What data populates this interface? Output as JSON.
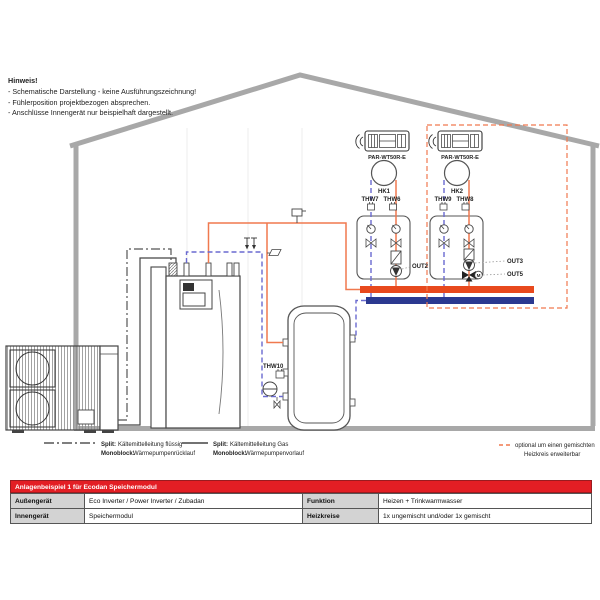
{
  "hinweis": {
    "title": "Hinweis!",
    "line1": "- Schematische Darstellung - keine Ausführungszeichnung!",
    "line2": "- Fühlerposition projektbezogen absprechen.",
    "line3": "- Anschlüsse Innengerät nur beispielhaft dargestellt."
  },
  "hk1": {
    "controller": "PAR-WT50R-E",
    "zone": "HK1",
    "sensor_return": "THW7",
    "sensor_flow": "THW6",
    "out_pump": "OUT2"
  },
  "hk2": {
    "controller": "PAR-WT50R-E",
    "zone": "HK2",
    "sensor_return": "THW9",
    "sensor_flow": "THW8",
    "out_pump": "OUT3",
    "out_mixer": "OUT5",
    "mixer_motor": "M"
  },
  "tank": {
    "sensor": "THW10"
  },
  "legend": {
    "item1": {
      "label1": "Split:",
      "text1": "Kältemittelleitung flüssig",
      "label2": "Monoblock:",
      "text2": "Wärmepumpenrücklauf"
    },
    "item2": {
      "label1": "Split:",
      "text1": "Kältemittelleitung Gas",
      "label2": "Monoblock:",
      "text2": "Wärmepumpenvorlauf"
    },
    "item3": {
      "line1": "optional um einen gemischten",
      "line2": "Heizkreis erweiterbar"
    }
  },
  "table": {
    "header": "Anlagenbeispiel 1 für Ecodan Speichermodul",
    "rows": [
      {
        "label1": "Außengerät",
        "value1": "Eco Inverter / Power Inverter / Zubadan",
        "label2": "Funktion",
        "value2": "Heizen + Trinkwarmwasser"
      },
      {
        "label1": "Innengerät",
        "value1": "Speichermodul",
        "label2": "Heizkreise",
        "value2": "1x ungemischt und/oder 1x gemischt"
      }
    ]
  },
  "colors": {
    "flow_orange": "#f0794f",
    "return_blue": "#6a6ad0",
    "bar_flow_red": "#e8491d",
    "bar_return_blue": "#2b3990",
    "optional_orange": "#f0794f",
    "table_header_red": "#e31e24",
    "house_gray": "#a8a8a8"
  }
}
